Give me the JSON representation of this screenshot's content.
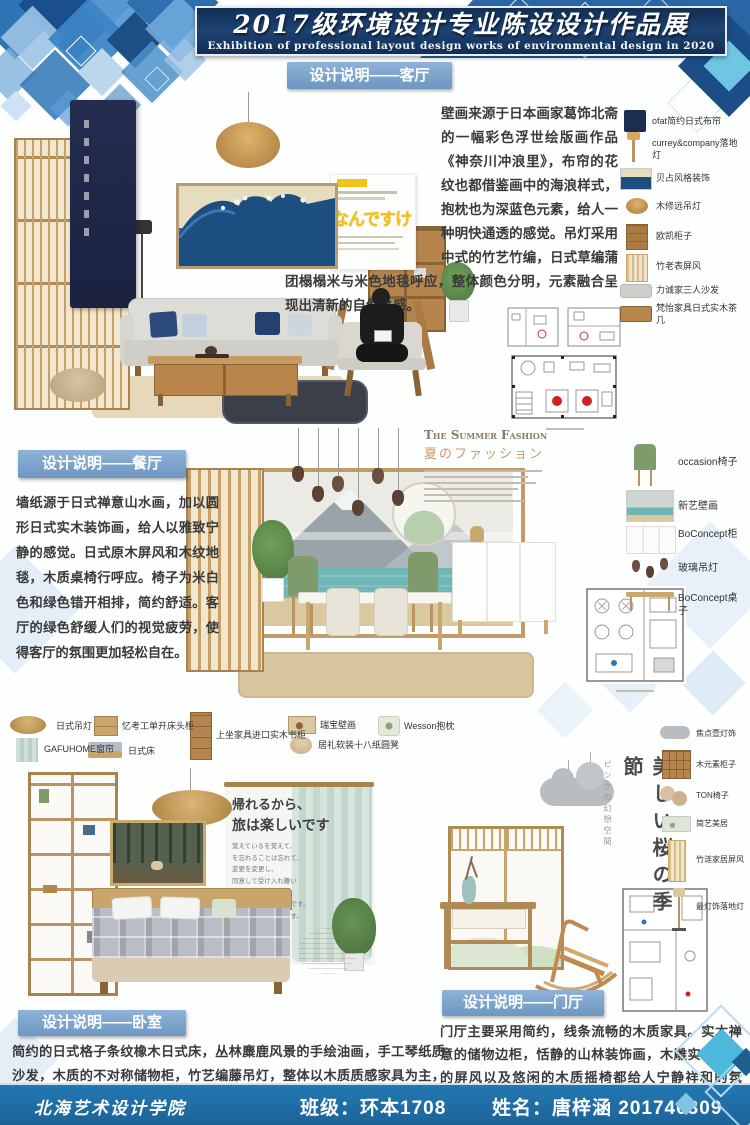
{
  "banner": {
    "title": "2017级环境设计专业陈设设计作品展",
    "subtitle": "Exhibition of professional layout design works of environmental design in 2020"
  },
  "living": {
    "header": "设计说明——客厅",
    "body": "壁画来源于日本画家葛饰北斋的一幅彩色浮世绘版画作品《神奈川冲浪里》，布帘的花纹也都借鉴画中的海浪样式，抱枕也为深蓝色元素，给人一种明快通透的感觉。吊灯采用中式的竹艺竹编，日式草编蒲团榻榻米与米色地毯呼应，整体颜色分明，元素融合呈现出清新的自然之感。",
    "poster_title": "なんですけ",
    "items": [
      "ofat简约日式布帘",
      "currey&company落地灯",
      "贝占风格装饰",
      "木修远吊灯",
      "欧凯柜子",
      "竹老表屏风",
      "力诚家三人沙发",
      "梵怡家具日式实木茶几"
    ]
  },
  "dining": {
    "header": "设计说明——餐厅",
    "body": "墙纸源于日式禅意山水画，加以圆形日式实木装饰画，给人以雅致宁静的感觉。日式原木屏风和木纹地毯，木质桌椅行呼应。椅子为米白色和绿色错开相排，简约舒适。客厅的绿色舒缓人们的视觉疲劳，使得客厅的氛围更加轻松自在。",
    "fashion_title": "The Summer Fashion",
    "fashion_sub": "夏のファッション",
    "items": [
      "occasion椅子",
      "新艺壁画",
      "BoConcept柜",
      "玻璃吊灯",
      "BoConcept桌子"
    ]
  },
  "bedroom": {
    "header": "设计说明——卧室",
    "body": "简约的日式格子条纹橡木日式床，丛林麋鹿风景的手绘油画，手工琴纸质沙发，木质的不对称储物柜，竹艺编藤吊灯，整体以木质质感家具为主，绿色盆栽在清新空气的同时也给空间增添了生机感，抱枕的植物花纹也与之呼应。",
    "quote1": "帰れるから、",
    "quote2": "旅は楽しいです",
    "quote_small": [
      "覚えているを覚えて、",
      "を忘れることは忘れて、",
      "変更を変更し、",
      "同意して受け入れ難い",
      "君がいるだから、",
      "今のわたしは、幸せです。",
      "ありがとうございます。"
    ],
    "items": [
      "日式吊灯",
      "GAFUHOME窗帘",
      "忆考工单开床头柜",
      "日式床",
      "上坐家具进口实木书柜",
      "瑞宝壁画",
      "居礼软装十八纸圆凳",
      "Wesson抱枕"
    ]
  },
  "hall": {
    "header": "设计说明——门厅",
    "body": "门厅主要采用简约，线条流畅的木质家具。实木禅意的储物边柜，恬静的山林装饰画，木雕实木花格的屏风以及悠闲的木质摇椅都给人宁静祥和的氛围，灰色的云朵饰吊灯给画面增加动态美，更是增添了淡雅的感觉。",
    "vertical_title": "美しい桜の季節",
    "vertical_sub": "ピンクの幻想空間",
    "items": [
      "焦点壹灯饰",
      "木元素柜子",
      "TON椅子",
      "简艺美居",
      "竹涟家居屏风",
      "最灯饰落地灯"
    ]
  },
  "footer": {
    "school": "北海艺术设计学院",
    "class_info": "班级：环本1708",
    "name_info": "姓名：唐梓涵 201740309"
  },
  "colors": {
    "banner_bg": "#1d4372",
    "badge_bg": "#7da4cb",
    "footer_bg": "#2378b3",
    "accent_blue": "#2e75b6",
    "wave_blue": "#1d4e80",
    "wood": "#c9a46b"
  }
}
